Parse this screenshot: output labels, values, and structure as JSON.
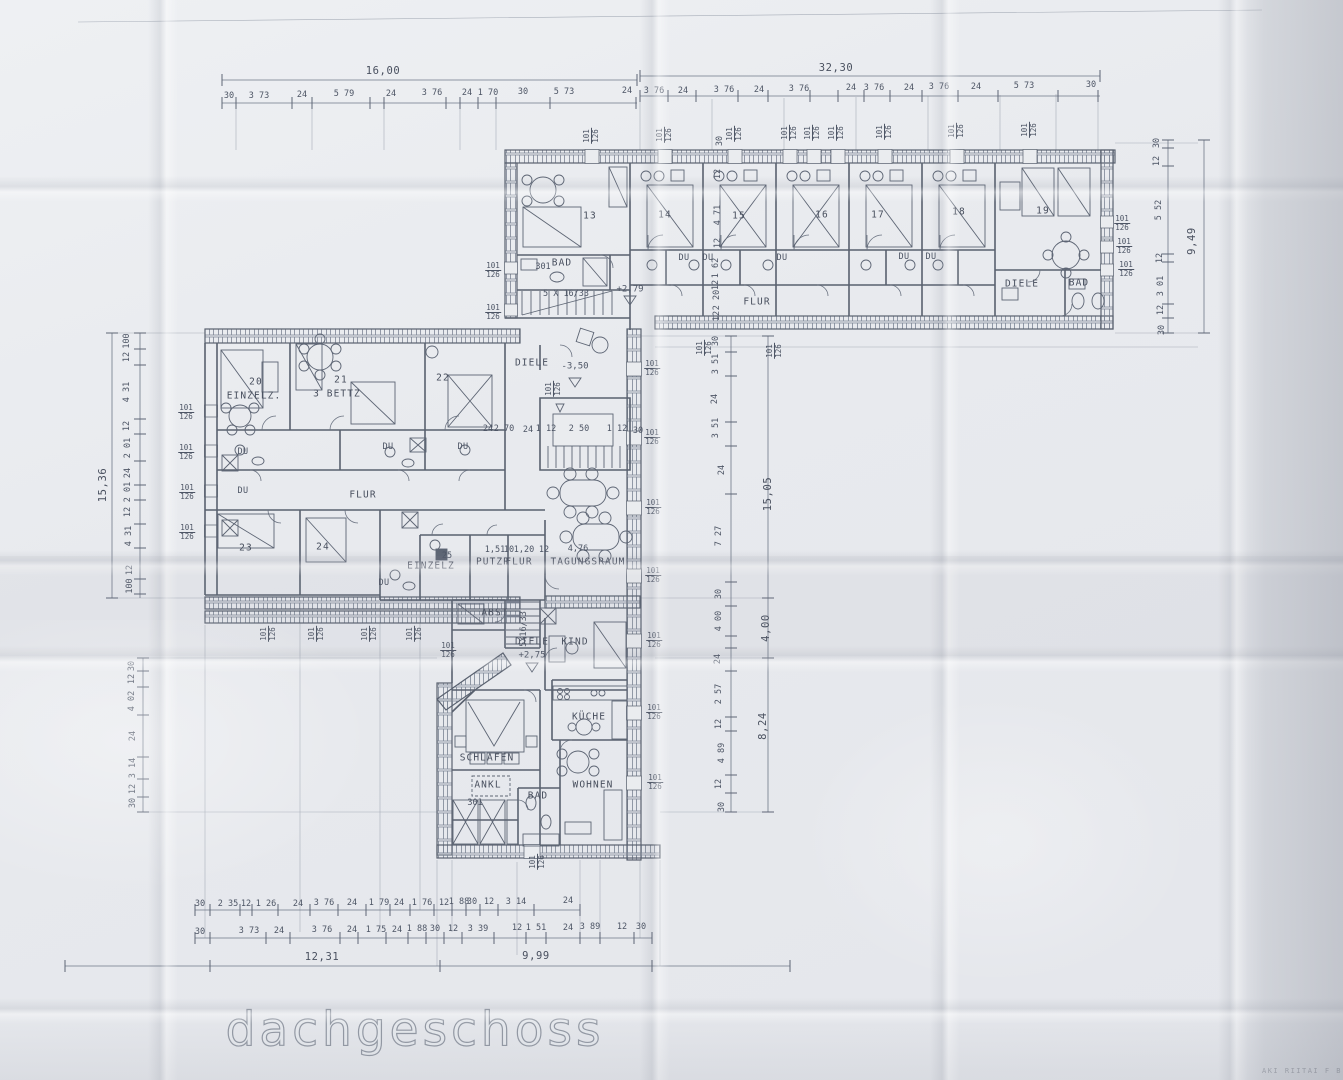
{
  "page_title": "dachgeschoss",
  "title": {
    "text": "dachgeschoss"
  },
  "corner_stamp": {
    "text": "AKI RIITAI F B"
  },
  "annotations": [
    {
      "t": "16,00",
      "x": 383,
      "y": 71,
      "c": "tot"
    },
    {
      "t": "30",
      "x": 229,
      "y": 96
    },
    {
      "t": "3 73",
      "x": 259,
      "y": 96
    },
    {
      "t": "24",
      "x": 302,
      "y": 95
    },
    {
      "t": "5 79",
      "x": 344,
      "y": 94
    },
    {
      "t": "24",
      "x": 391,
      "y": 94
    },
    {
      "t": "3 76",
      "x": 432,
      "y": 93
    },
    {
      "t": "24",
      "x": 467,
      "y": 93
    },
    {
      "t": "1 70",
      "x": 488,
      "y": 93
    },
    {
      "t": "30",
      "x": 523,
      "y": 92
    },
    {
      "t": "5 73",
      "x": 564,
      "y": 92
    },
    {
      "t": "24",
      "x": 627,
      "y": 91
    },
    {
      "t": "32,30",
      "x": 836,
      "y": 68,
      "c": "tot"
    },
    {
      "t": "3 76",
      "x": 654,
      "y": 91
    },
    {
      "t": "24",
      "x": 683,
      "y": 91
    },
    {
      "t": "3 76",
      "x": 724,
      "y": 90
    },
    {
      "t": "24",
      "x": 759,
      "y": 90
    },
    {
      "t": "3 76",
      "x": 799,
      "y": 89
    },
    {
      "t": "24",
      "x": 851,
      "y": 88
    },
    {
      "t": "3 76",
      "x": 874,
      "y": 88
    },
    {
      "t": "24",
      "x": 909,
      "y": 88
    },
    {
      "t": "3 76",
      "x": 939,
      "y": 87
    },
    {
      "t": "24",
      "x": 976,
      "y": 87
    },
    {
      "t": "5 73",
      "x": 1024,
      "y": 86
    },
    {
      "t": "30",
      "x": 1091,
      "y": 85
    },
    {
      "t": "30",
      "x": 1157,
      "y": 143,
      "r": -90
    },
    {
      "t": "12",
      "x": 1157,
      "y": 161,
      "r": -90
    },
    {
      "t": "5 52",
      "x": 1159,
      "y": 210,
      "r": -90
    },
    {
      "t": "12",
      "x": 1160,
      "y": 258,
      "r": -90
    },
    {
      "t": "3 01",
      "x": 1161,
      "y": 286,
      "r": -90
    },
    {
      "t": "12",
      "x": 1161,
      "y": 310,
      "r": -90
    },
    {
      "t": "30",
      "x": 1162,
      "y": 330,
      "r": -90
    },
    {
      "t": "9,49",
      "x": 1192,
      "y": 241,
      "r": -90,
      "c": "tot"
    },
    {
      "t": "101/126",
      "x": 1122,
      "y": 223,
      "c": "frac"
    },
    {
      "t": "101/126",
      "x": 1124,
      "y": 246,
      "c": "frac"
    },
    {
      "t": "101/126",
      "x": 1126,
      "y": 269,
      "c": "frac"
    },
    {
      "t": "100",
      "x": 127,
      "y": 341,
      "r": -90
    },
    {
      "t": "12",
      "x": 127,
      "y": 357,
      "r": -90
    },
    {
      "t": "4 31",
      "x": 127,
      "y": 392,
      "r": -90
    },
    {
      "t": "12",
      "x": 127,
      "y": 426,
      "r": -90
    },
    {
      "t": "2 01",
      "x": 128,
      "y": 448,
      "r": -90
    },
    {
      "t": "24",
      "x": 128,
      "y": 473,
      "r": -90
    },
    {
      "t": "2 01",
      "x": 128,
      "y": 492,
      "r": -90
    },
    {
      "t": "12",
      "x": 128,
      "y": 512,
      "r": -90
    },
    {
      "t": "4 31",
      "x": 129,
      "y": 536,
      "r": -90
    },
    {
      "t": "12",
      "x": 130,
      "y": 570,
      "r": -90
    },
    {
      "t": "100",
      "x": 130,
      "y": 586,
      "r": -90
    },
    {
      "t": "15,36",
      "x": 103,
      "y": 485,
      "r": -90,
      "c": "tot"
    },
    {
      "t": "101/126",
      "x": 186,
      "y": 412,
      "c": "frac"
    },
    {
      "t": "101/126",
      "x": 186,
      "y": 452,
      "c": "frac"
    },
    {
      "t": "101/126",
      "x": 187,
      "y": 492,
      "c": "frac"
    },
    {
      "t": "101/126",
      "x": 187,
      "y": 532,
      "c": "frac"
    },
    {
      "t": "30",
      "x": 132,
      "y": 666,
      "r": -90
    },
    {
      "t": "12",
      "x": 132,
      "y": 679,
      "r": -90
    },
    {
      "t": "4 02",
      "x": 132,
      "y": 701,
      "r": -90
    },
    {
      "t": "24",
      "x": 133,
      "y": 736,
      "r": -90
    },
    {
      "t": "3 14",
      "x": 133,
      "y": 768,
      "r": -90
    },
    {
      "t": "12",
      "x": 133,
      "y": 789,
      "r": -90
    },
    {
      "t": "30",
      "x": 133,
      "y": 803,
      "r": -90
    },
    {
      "t": "30",
      "x": 716,
      "y": 341,
      "r": -90
    },
    {
      "t": "3 51",
      "x": 716,
      "y": 364,
      "r": -90
    },
    {
      "t": "24",
      "x": 715,
      "y": 399,
      "r": -90
    },
    {
      "t": "3 51",
      "x": 716,
      "y": 428,
      "r": -90
    },
    {
      "t": "24",
      "x": 722,
      "y": 470,
      "r": -90
    },
    {
      "t": "7 27",
      "x": 719,
      "y": 536,
      "r": -90
    },
    {
      "t": "30",
      "x": 719,
      "y": 594,
      "r": -90
    },
    {
      "t": "4 00",
      "x": 719,
      "y": 621,
      "r": -90
    },
    {
      "t": "24",
      "x": 718,
      "y": 659,
      "r": -90
    },
    {
      "t": "2 57",
      "x": 719,
      "y": 694,
      "r": -90
    },
    {
      "t": "12",
      "x": 719,
      "y": 724,
      "r": -90
    },
    {
      "t": "4 89",
      "x": 722,
      "y": 753,
      "r": -90
    },
    {
      "t": "12",
      "x": 719,
      "y": 784,
      "r": -90
    },
    {
      "t": "30",
      "x": 722,
      "y": 807,
      "r": -90
    },
    {
      "t": "15,05",
      "x": 768,
      "y": 494,
      "r": -90,
      "c": "tot"
    },
    {
      "t": "4,00",
      "x": 766,
      "y": 628,
      "r": -90,
      "c": "tot"
    },
    {
      "t": "8,24",
      "x": 763,
      "y": 726,
      "r": -90,
      "c": "tot"
    },
    {
      "t": "101/126",
      "x": 704,
      "y": 348,
      "r": -90,
      "c": "frac"
    },
    {
      "t": "101/126",
      "x": 774,
      "y": 351,
      "r": -90,
      "c": "frac"
    },
    {
      "t": "101/126",
      "x": 652,
      "y": 368,
      "c": "frac"
    },
    {
      "t": "101/126",
      "x": 652,
      "y": 437,
      "c": "frac"
    },
    {
      "t": "101/126",
      "x": 653,
      "y": 507,
      "c": "frac"
    },
    {
      "t": "101/126",
      "x": 653,
      "y": 575,
      "c": "frac"
    },
    {
      "t": "101/126",
      "x": 654,
      "y": 640,
      "c": "frac"
    },
    {
      "t": "101/126",
      "x": 654,
      "y": 712,
      "c": "frac"
    },
    {
      "t": "101/126",
      "x": 655,
      "y": 782,
      "c": "frac"
    },
    {
      "t": "30",
      "x": 200,
      "y": 904
    },
    {
      "t": "2 35",
      "x": 228,
      "y": 904
    },
    {
      "t": "12",
      "x": 246,
      "y": 904
    },
    {
      "t": "1 26",
      "x": 266,
      "y": 904
    },
    {
      "t": "24",
      "x": 298,
      "y": 904
    },
    {
      "t": "3 76",
      "x": 324,
      "y": 903
    },
    {
      "t": "24",
      "x": 352,
      "y": 903
    },
    {
      "t": "1 79",
      "x": 379,
      "y": 903
    },
    {
      "t": "24",
      "x": 399,
      "y": 903
    },
    {
      "t": "1 76",
      "x": 422,
      "y": 903
    },
    {
      "t": "12",
      "x": 444,
      "y": 903
    },
    {
      "t": "1 88",
      "x": 459,
      "y": 902
    },
    {
      "t": "30",
      "x": 472,
      "y": 902
    },
    {
      "t": "12",
      "x": 489,
      "y": 902
    },
    {
      "t": "3 14",
      "x": 516,
      "y": 902
    },
    {
      "t": "24",
      "x": 568,
      "y": 901
    },
    {
      "t": "30",
      "x": 200,
      "y": 932
    },
    {
      "t": "3 73",
      "x": 249,
      "y": 931
    },
    {
      "t": "24",
      "x": 279,
      "y": 931
    },
    {
      "t": "3 76",
      "x": 322,
      "y": 930
    },
    {
      "t": "24",
      "x": 352,
      "y": 930
    },
    {
      "t": "1 75",
      "x": 376,
      "y": 930
    },
    {
      "t": "24",
      "x": 397,
      "y": 930
    },
    {
      "t": "1 88",
      "x": 417,
      "y": 929
    },
    {
      "t": "30",
      "x": 435,
      "y": 929
    },
    {
      "t": "12",
      "x": 453,
      "y": 929
    },
    {
      "t": "3 39",
      "x": 478,
      "y": 929
    },
    {
      "t": "12",
      "x": 517,
      "y": 928
    },
    {
      "t": "1 51",
      "x": 536,
      "y": 928
    },
    {
      "t": "24",
      "x": 568,
      "y": 928
    },
    {
      "t": "3 89",
      "x": 590,
      "y": 927
    },
    {
      "t": "12",
      "x": 622,
      "y": 927
    },
    {
      "t": "30",
      "x": 641,
      "y": 927
    },
    {
      "t": "12,31",
      "x": 322,
      "y": 957,
      "c": "tot"
    },
    {
      "t": "9,99",
      "x": 536,
      "y": 956,
      "c": "tot"
    },
    {
      "t": "13",
      "x": 590,
      "y": 216,
      "c": "room"
    },
    {
      "t": "14",
      "x": 665,
      "y": 215,
      "c": "room"
    },
    {
      "t": "15",
      "x": 739,
      "y": 216,
      "c": "room"
    },
    {
      "t": "16",
      "x": 822,
      "y": 215,
      "c": "room"
    },
    {
      "t": "17",
      "x": 878,
      "y": 215,
      "c": "room"
    },
    {
      "t": "18",
      "x": 959,
      "y": 212,
      "c": "room"
    },
    {
      "t": "19",
      "x": 1043,
      "y": 211,
      "c": "room"
    },
    {
      "t": "301",
      "x": 543,
      "y": 267
    },
    {
      "t": "BAD",
      "x": 562,
      "y": 263,
      "c": "room"
    },
    {
      "t": "5 X 16/33",
      "x": 566,
      "y": 294
    },
    {
      "t": "+2,79",
      "x": 630,
      "y": 290,
      "c": "lvl"
    },
    {
      "t": "DU",
      "x": 684,
      "y": 258,
      "c": "du"
    },
    {
      "t": "DU",
      "x": 708,
      "y": 258,
      "c": "du"
    },
    {
      "t": "DU",
      "x": 782,
      "y": 258,
      "c": "du"
    },
    {
      "t": "DU",
      "x": 904,
      "y": 257,
      "c": "du"
    },
    {
      "t": "DU",
      "x": 931,
      "y": 257,
      "c": "du"
    },
    {
      "t": "12",
      "x": 718,
      "y": 174,
      "r": -90
    },
    {
      "t": "4 71",
      "x": 718,
      "y": 215,
      "r": -90
    },
    {
      "t": "12",
      "x": 718,
      "y": 243,
      "r": -90
    },
    {
      "t": "1 62",
      "x": 716,
      "y": 268,
      "r": -90
    },
    {
      "t": "12",
      "x": 716,
      "y": 285,
      "r": -90
    },
    {
      "t": "2 20",
      "x": 717,
      "y": 300,
      "r": -90
    },
    {
      "t": "12",
      "x": 717,
      "y": 316,
      "r": -90
    },
    {
      "t": "FLUR",
      "x": 757,
      "y": 302,
      "c": "room"
    },
    {
      "t": "DIELE",
      "x": 1022,
      "y": 284,
      "c": "room"
    },
    {
      "t": "BAD",
      "x": 1079,
      "y": 283,
      "c": "room"
    },
    {
      "t": "101/126",
      "x": 591,
      "y": 136,
      "r": -90,
      "c": "frac"
    },
    {
      "t": "101/126",
      "x": 664,
      "y": 135,
      "r": -90,
      "c": "frac"
    },
    {
      "t": "101/126",
      "x": 734,
      "y": 134,
      "r": -90,
      "c": "frac"
    },
    {
      "t": "101/126",
      "x": 789,
      "y": 133,
      "r": -90,
      "c": "frac"
    },
    {
      "t": "101/126",
      "x": 812,
      "y": 133,
      "r": -90,
      "c": "frac"
    },
    {
      "t": "101/126",
      "x": 836,
      "y": 133,
      "r": -90,
      "c": "frac"
    },
    {
      "t": "101/126",
      "x": 884,
      "y": 132,
      "r": -90,
      "c": "frac"
    },
    {
      "t": "101/126",
      "x": 956,
      "y": 131,
      "r": -90,
      "c": "frac"
    },
    {
      "t": "101/126",
      "x": 1029,
      "y": 130,
      "r": -90,
      "c": "frac"
    },
    {
      "t": "30",
      "x": 720,
      "y": 141,
      "r": -90
    },
    {
      "t": "101/126",
      "x": 493,
      "y": 270,
      "c": "frac"
    },
    {
      "t": "101/126",
      "x": 493,
      "y": 312,
      "c": "frac"
    },
    {
      "t": "20",
      "x": 256,
      "y": 382,
      "c": "room"
    },
    {
      "t": "EINZELZ.",
      "x": 254,
      "y": 396,
      "c": "room"
    },
    {
      "t": "21",
      "x": 341,
      "y": 380,
      "c": "room"
    },
    {
      "t": "3 BETTZ",
      "x": 337,
      "y": 394,
      "c": "room"
    },
    {
      "t": "22",
      "x": 443,
      "y": 378,
      "c": "room"
    },
    {
      "t": "DU",
      "x": 243,
      "y": 452,
      "c": "du"
    },
    {
      "t": "DU",
      "x": 388,
      "y": 447,
      "c": "du"
    },
    {
      "t": "DU",
      "x": 463,
      "y": 447,
      "c": "du"
    },
    {
      "t": "DU",
      "x": 243,
      "y": 491,
      "c": "du"
    },
    {
      "t": "FLUR",
      "x": 363,
      "y": 495,
      "c": "room"
    },
    {
      "t": "23",
      "x": 246,
      "y": 548,
      "c": "room"
    },
    {
      "t": "24",
      "x": 323,
      "y": 547,
      "c": "room"
    },
    {
      "t": "DU",
      "x": 384,
      "y": 583,
      "c": "du"
    },
    {
      "t": "25",
      "x": 447,
      "y": 556
    },
    {
      "t": "EINZELZ",
      "x": 431,
      "y": 566,
      "c": "room"
    },
    {
      "t": "PUTZR",
      "x": 493,
      "y": 562,
      "c": "room"
    },
    {
      "t": "FLUR",
      "x": 519,
      "y": 562,
      "c": "room"
    },
    {
      "t": "TAGUNGSRAUM",
      "x": 588,
      "y": 562,
      "c": "room"
    },
    {
      "t": "4,76",
      "x": 578,
      "y": 549
    },
    {
      "t": "1,51",
      "x": 495,
      "y": 550
    },
    {
      "t": "10",
      "x": 509,
      "y": 550
    },
    {
      "t": "1,20",
      "x": 524,
      "y": 550
    },
    {
      "t": "12",
      "x": 544,
      "y": 550
    },
    {
      "t": "24",
      "x": 488,
      "y": 429
    },
    {
      "t": "2 70",
      "x": 504,
      "y": 429
    },
    {
      "t": "24",
      "x": 528,
      "y": 430
    },
    {
      "t": "1 12",
      "x": 546,
      "y": 429
    },
    {
      "t": "2 50",
      "x": 579,
      "y": 429
    },
    {
      "t": "1 12",
      "x": 617,
      "y": 429
    },
    {
      "t": "30",
      "x": 638,
      "y": 431
    },
    {
      "t": "DIELE",
      "x": 532,
      "y": 363,
      "c": "room"
    },
    {
      "t": "-3,50",
      "x": 575,
      "y": 367,
      "c": "lvl"
    },
    {
      "t": "101/126",
      "x": 553,
      "y": 389,
      "r": -90,
      "c": "frac"
    },
    {
      "t": "ABST",
      "x": 495,
      "y": 613,
      "c": "room"
    },
    {
      "t": "5X16/33",
      "x": 524,
      "y": 629,
      "r": -90
    },
    {
      "t": "DIELE",
      "x": 532,
      "y": 642,
      "c": "room"
    },
    {
      "t": "+2,75",
      "x": 532,
      "y": 656,
      "c": "lvl"
    },
    {
      "t": "KIND",
      "x": 575,
      "y": 642,
      "c": "room"
    },
    {
      "t": "101/126",
      "x": 268,
      "y": 634,
      "r": -90,
      "c": "frac"
    },
    {
      "t": "101/126",
      "x": 316,
      "y": 634,
      "r": -90,
      "c": "frac"
    },
    {
      "t": "101/126",
      "x": 369,
      "y": 634,
      "r": -90,
      "c": "frac"
    },
    {
      "t": "101/126",
      "x": 414,
      "y": 634,
      "r": -90,
      "c": "frac"
    },
    {
      "t": "101/126",
      "x": 448,
      "y": 650,
      "c": "frac"
    },
    {
      "t": "SCHLAFEN",
      "x": 487,
      "y": 758,
      "c": "room"
    },
    {
      "t": "ANKL",
      "x": 488,
      "y": 785,
      "c": "room"
    },
    {
      "t": "301",
      "x": 475,
      "y": 803
    },
    {
      "t": "BAD",
      "x": 538,
      "y": 796,
      "c": "room"
    },
    {
      "t": "KÜCHE",
      "x": 589,
      "y": 717,
      "c": "room"
    },
    {
      "t": "WOHNEN",
      "x": 593,
      "y": 785,
      "c": "room"
    },
    {
      "t": "101/126",
      "x": 537,
      "y": 862,
      "r": -90,
      "c": "frac"
    }
  ]
}
